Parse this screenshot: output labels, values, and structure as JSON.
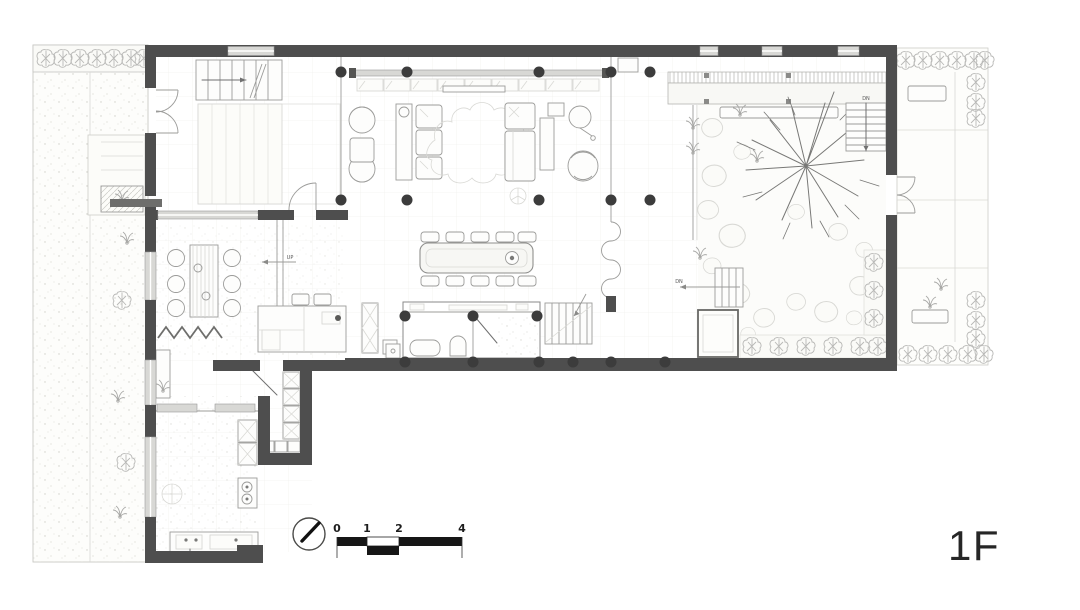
{
  "drawing": {
    "floor_label": "1F",
    "scale_bar": {
      "tick_labels": [
        "0",
        "1",
        "2",
        "4"
      ]
    },
    "stair_labels": {
      "down_garden": "DN",
      "down_courtyard": "DN",
      "up_interior": "UP"
    },
    "colors": {
      "background": "#ffffff",
      "wall": "#4e4e4e",
      "column": "#3c3c3c",
      "window_fill": "#d8d8d5",
      "line_dark": "#707070",
      "line_mid": "#9c9c9a",
      "line_light": "#d9d9d5",
      "floor_tint": "#fcfcfa",
      "text": "#262626"
    }
  }
}
